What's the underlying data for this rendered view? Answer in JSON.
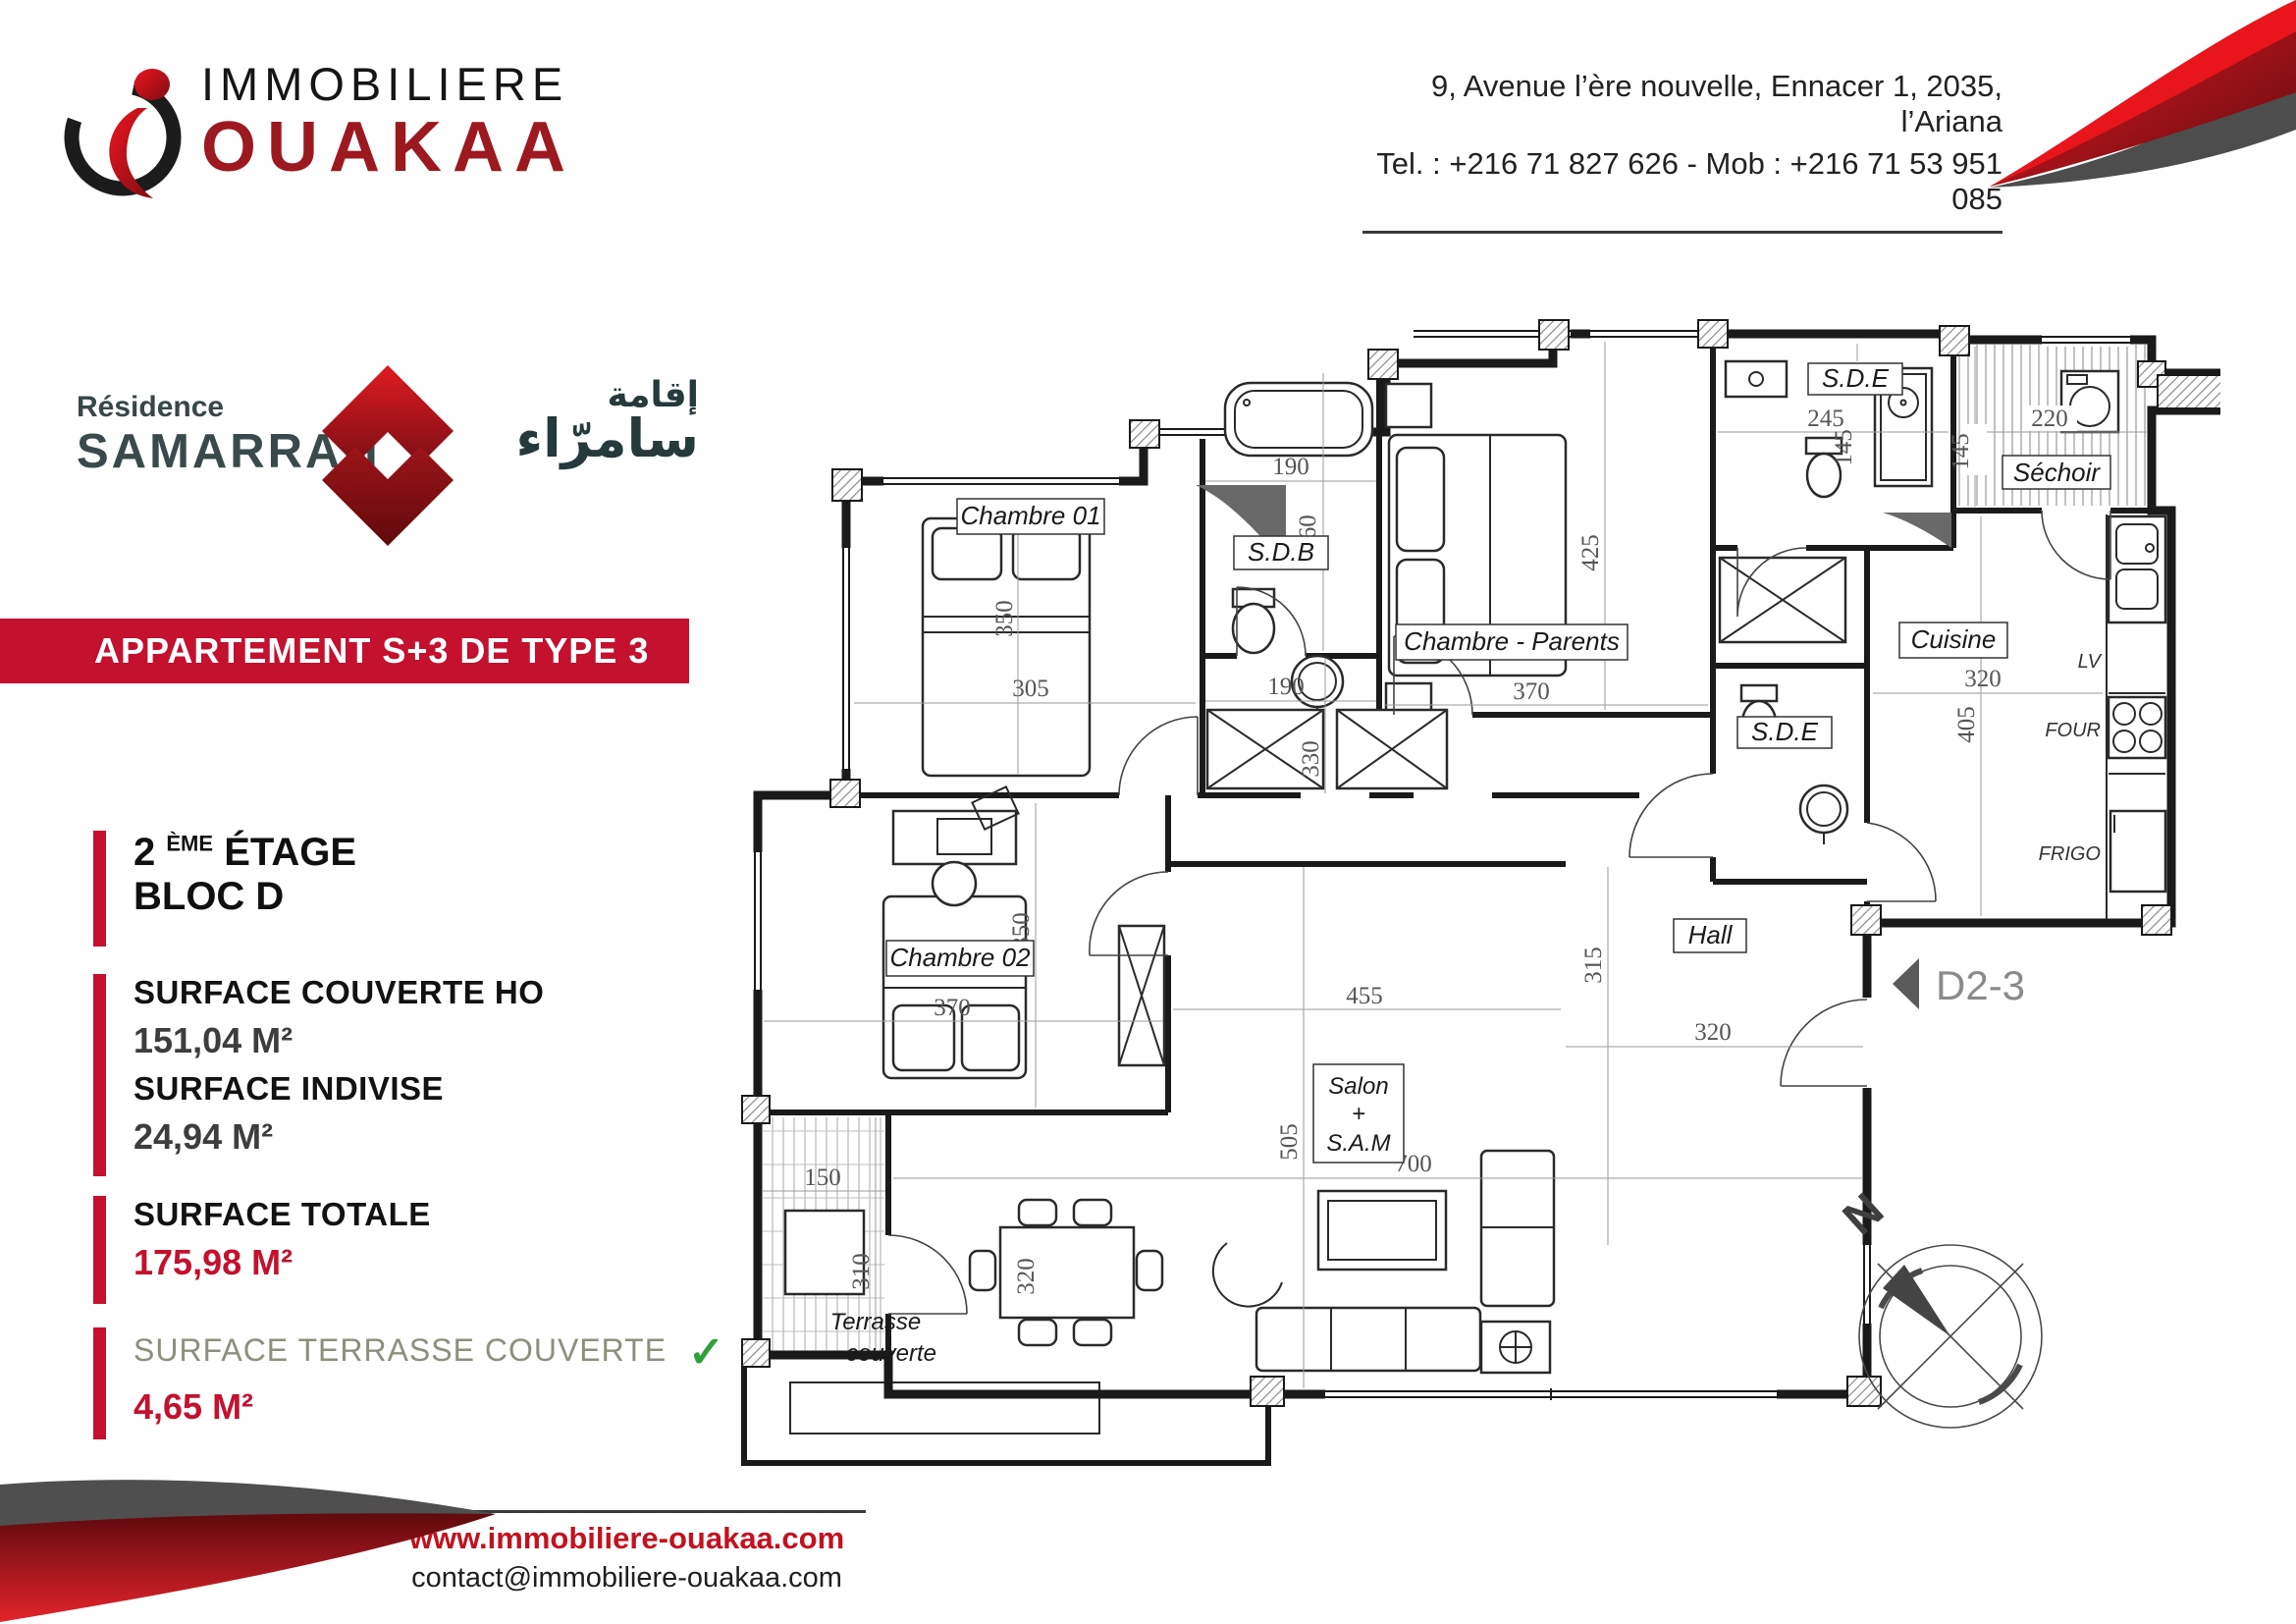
{
  "header": {
    "company_line1": "IMMOBILIERE",
    "company_line2": "OUAKAA",
    "address_line1": "9, Avenue l’ère nouvelle, Ennacer 1, 2035, l’Ariana",
    "address_line2": "Tel. : +216 71 827 626 - Mob : +216 71 53 951 085"
  },
  "residence": {
    "label": "Résidence",
    "name": "SAMARRAH",
    "arabic_top": "إقامة",
    "arabic_bottom": "سامرّاء"
  },
  "banner": {
    "title": "APPARTEMENT S+3 DE TYPE 3"
  },
  "info": {
    "floor": {
      "num": "2",
      "sup": "ÈME",
      "word": "ÉTAGE",
      "bloc": "BLOC D"
    },
    "surfaces": [
      {
        "label": "SURFACE COUVERTE HO",
        "value": "151,04 M²"
      },
      {
        "label": "SURFACE INDIVISE",
        "value": "24,94 M²"
      },
      {
        "label": "SURFACE TOTALE",
        "value": "175,98 M²"
      },
      {
        "label": "SURFACE TERRASSE COUVERTE",
        "value": "4,65 M²",
        "check": "✓"
      }
    ]
  },
  "footer": {
    "website": "www.immobiliere-ouakaa.com",
    "email": "contact@immobiliere-ouakaa.com"
  },
  "floorplan": {
    "rooms": {
      "chambre01": "Chambre 01",
      "sdb": "S.D.B",
      "parents": "Chambre - Parents",
      "sde_top": "S.D.E",
      "sechoir": "Séchoir",
      "cuisine": "Cuisine",
      "sde_mid": "S.D.E",
      "hall": "Hall",
      "chambre02": "Chambre 02",
      "salon_line1": "Salon",
      "salon_line2": "+",
      "salon_line3": "S.A.M",
      "terrasse_line1": "Terrasse",
      "terrasse_line2": "couverte"
    },
    "dims": {
      "chambre01_h": "350",
      "chambre01_w": "305",
      "sdb_w": "190",
      "sdb_h": "260",
      "corridor_w": "190",
      "parents_h": "425",
      "parents_w": "370",
      "sde_top_w": "245",
      "sde_top_h": "145",
      "sechoir_w": "220",
      "sechoir_h": "145",
      "cuisine_w": "320",
      "cuisine_h": "405",
      "corridor_h": "330",
      "corridor_w2": "455",
      "hall_h": "315",
      "hall_w": "320",
      "chambre02_w": "370",
      "chambre02_h": "350",
      "terrasse_w": "150",
      "terrasse_h": "310",
      "salon_w": "700",
      "salon_h": "505",
      "table_l": "320"
    },
    "appliances": {
      "lv": "LV",
      "four": "FOUR",
      "frigo": "FRIGO"
    },
    "marker": "D2-3",
    "north": "N"
  },
  "colors": {
    "brand_red": "#c3112e",
    "logo_dark_red": "#9c1920",
    "slate": "#3a4a4c",
    "check_green": "#2ea13a",
    "footer_red": "#c3121f"
  }
}
